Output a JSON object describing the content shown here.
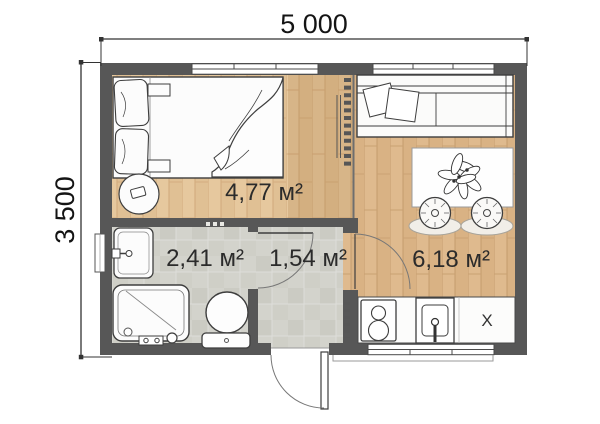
{
  "dims": {
    "width_label": "5 000",
    "height_label": "3 500"
  },
  "rooms": [
    {
      "id": "bedroom",
      "area_label": "4,77 м²"
    },
    {
      "id": "bathroom",
      "area_label": "2,41 м²"
    },
    {
      "id": "hallway",
      "area_label": "1,54 м²"
    },
    {
      "id": "living-kitchen",
      "area_label": "6,18 м²"
    }
  ],
  "kitchen": {
    "unit_label": "X"
  },
  "colors": {
    "wall": "#575757",
    "wood_floor": "#d9b284",
    "wood_floor_light": "#e3c69c",
    "tile_floor": "#d3d3cc",
    "furniture_outline": "#3e3e3e",
    "dimension_text": "#141414",
    "background": "#ffffff"
  }
}
